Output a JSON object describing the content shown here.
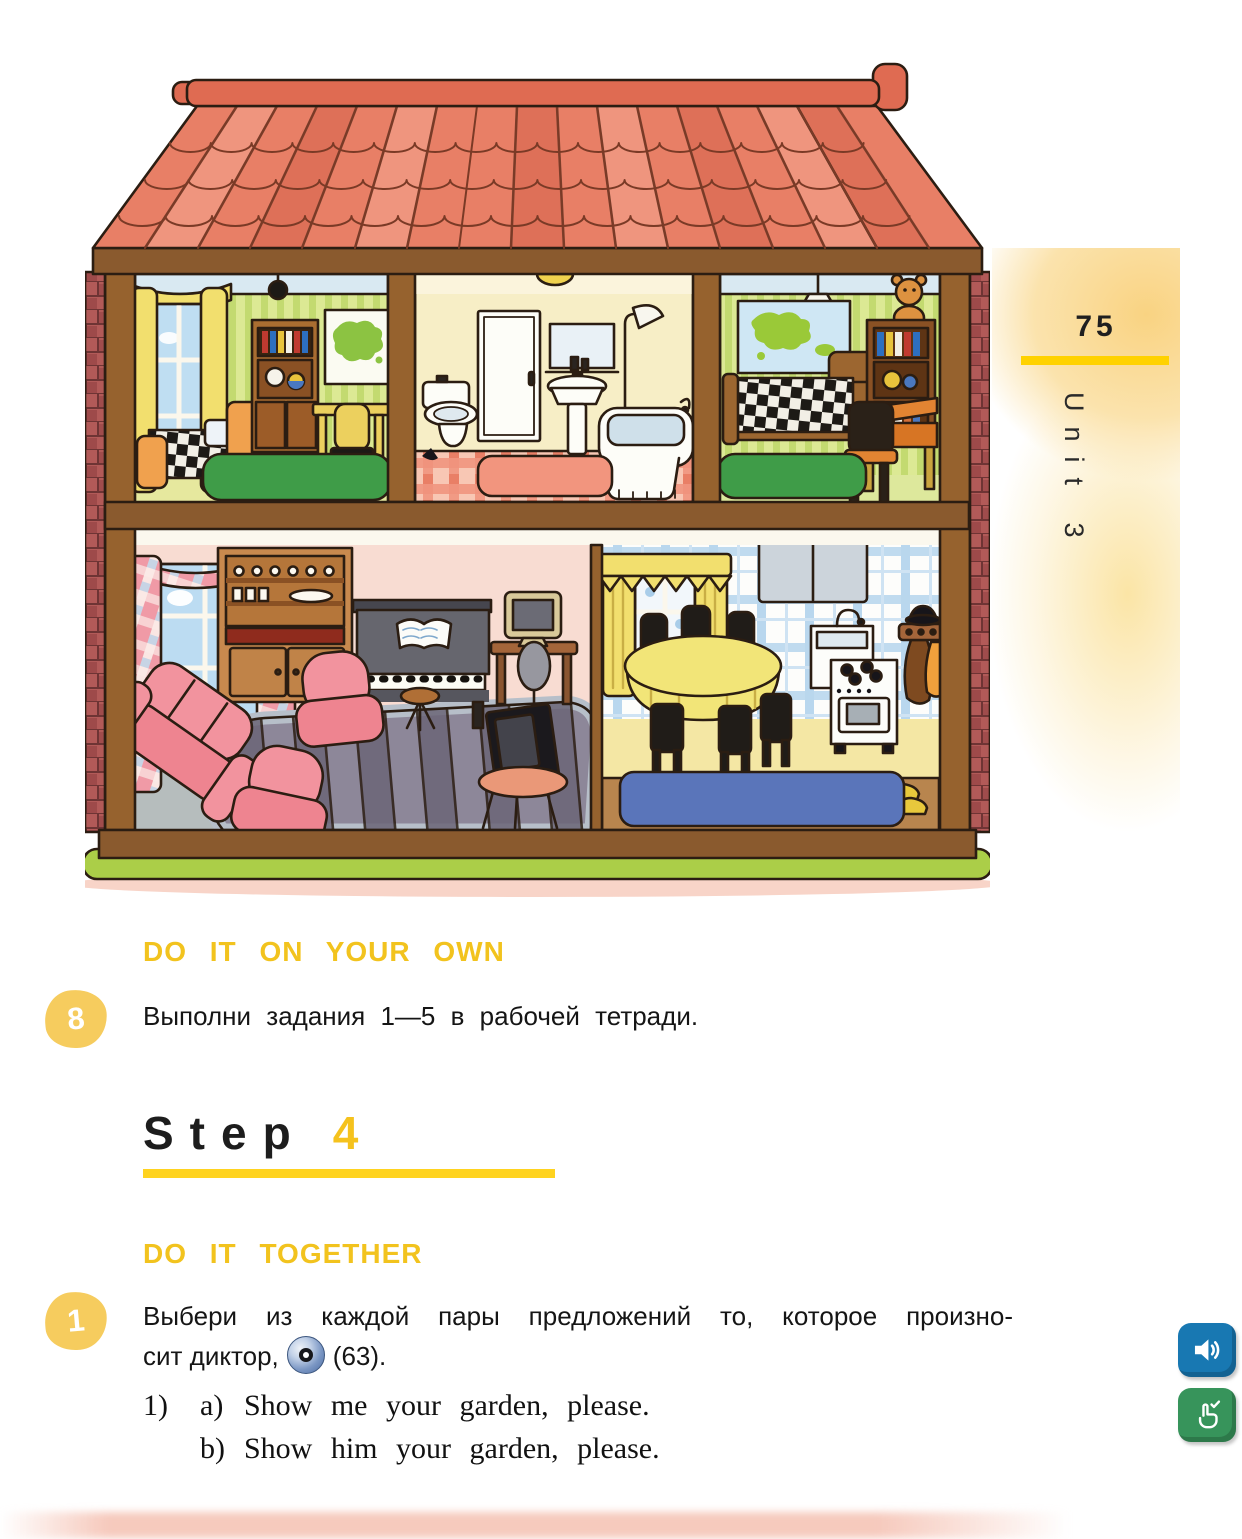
{
  "page": {
    "number": "75",
    "unit": "Unit 3"
  },
  "sections": {
    "own_heading": "DO IT ON YOUR OWN",
    "ex8": {
      "badge": "8",
      "text": "Выполни задания 1—5 в рабочей тетради."
    },
    "step": {
      "word": "Step",
      "number": "4"
    },
    "together_heading": "DO IT TOGETHER",
    "ex1": {
      "badge": "1",
      "line1": "Выбери из каждой пары предложений то, которое произно-",
      "line2_pre": "сит диктор,",
      "line2_post": "(63).",
      "item": {
        "num": "1)",
        "a_label": "a)",
        "a_text": "Show me your garden, please.",
        "b_label": "b)",
        "b_text": "Show him your garden, please."
      }
    }
  },
  "icons": {
    "cd_inline": "cd-disc",
    "audio_button": "speaker",
    "check_button": "hand-pointer-check"
  },
  "colors": {
    "accent_yellow": "#f2c31e",
    "rule_yellow": "#ffd200",
    "badge_yellow": "#f6cc5e",
    "button_blue": "#1878b2",
    "button_green": "#37945b"
  }
}
